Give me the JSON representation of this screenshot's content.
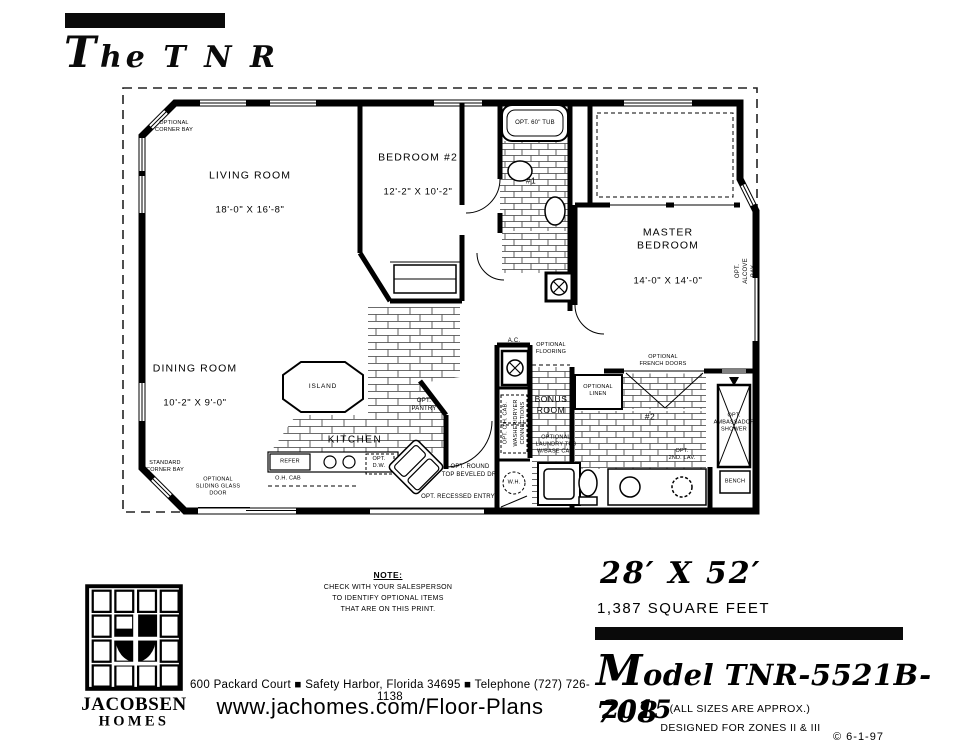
{
  "header": {
    "title": "The T N R"
  },
  "plan": {
    "rooms": {
      "living": {
        "name": "LIVING ROOM",
        "dims": "18'-0\" X 16'-8\""
      },
      "bedroom2": {
        "name": "BEDROOM #2",
        "dims": "12'-2\" X 10'-2\""
      },
      "master": {
        "name": "MASTER BEDROOM",
        "dims": "14'-0\" X 14'-0\""
      },
      "dining": {
        "name": "DINING ROOM",
        "dims": "10'-2\" X 9'-0\""
      },
      "kitchen": {
        "name": "KITCHEN"
      },
      "bonus": {
        "name": "BONUS\nROOM"
      },
      "bath1": {
        "name": "#1"
      },
      "bath2": {
        "name": "#2"
      }
    },
    "labels": {
      "opt_corner_bay": "OPTIONAL\nCORNER BAY",
      "standard_corner_bay": "STANDARD\nCORNER BAY",
      "opt_sliding_door": "OPTIONAL\nSLIDING GLASS\nDOOR",
      "island": "ISLAND",
      "opt_pantry": "OPT.\nPANTRY",
      "refer": "REFER",
      "oh_cab": "O.H. CAB",
      "opt_dw": "OPT.\nD.W.",
      "opt_round_top": "OPT. ROUND\nTOP BEVELED DR.",
      "opt_recessed_entry": "OPT. RECESSED ENTRY",
      "opt_tub": "OPT. 60\" TUB",
      "opt_alcove_bay": "OPT. ALCOVE BAY",
      "ac": "A.C.",
      "opt_flooring": "OPTIONAL\nFLOORING",
      "opt_oh_cab": "OPT. O.H. CAB.",
      "washer_dryer": "WASHER/DRYER\nCONNECTIONS",
      "wh": "W.H.",
      "opt_laundry_tub": "OPTIONAL\nLAUNDRY TUB\nW/BASE CAB.",
      "opt_linen": "OPTIONAL\nLINEN",
      "opt_french_doors": "OPTIONAL\nFRENCH DOORS",
      "opt_2nd_lav": "OPT.\n2ND. LAV.",
      "opt_ambassador": "OPT.\nAMBASSADOR\nSHOWER",
      "bench": "BENCH"
    }
  },
  "footer": {
    "note_title": "NOTE:",
    "note_body": "CHECK WITH YOUR SALESPERSON\nTO IDENTIFY OPTIONAL ITEMS\nTHAT ARE ON THIS PRINT.",
    "logo_line1": "JACOBSEN",
    "logo_line2": "HOMES",
    "address": "600 Packard Court ■ Safety Harbor, Florida 34695 ■ Telephone (727) 726-1138",
    "website": "www.jachomes.com/Floor-Plans",
    "size": "28′ X 52′",
    "sqft": "1,387 SQUARE FEET",
    "model": "Model TNR-5521B-708",
    "year": "2015",
    "approx": "(ALL SIZES ARE APPROX.)",
    "zones": "DESIGNED FOR ZONES II & III",
    "copyright": "© 6-1-97"
  }
}
